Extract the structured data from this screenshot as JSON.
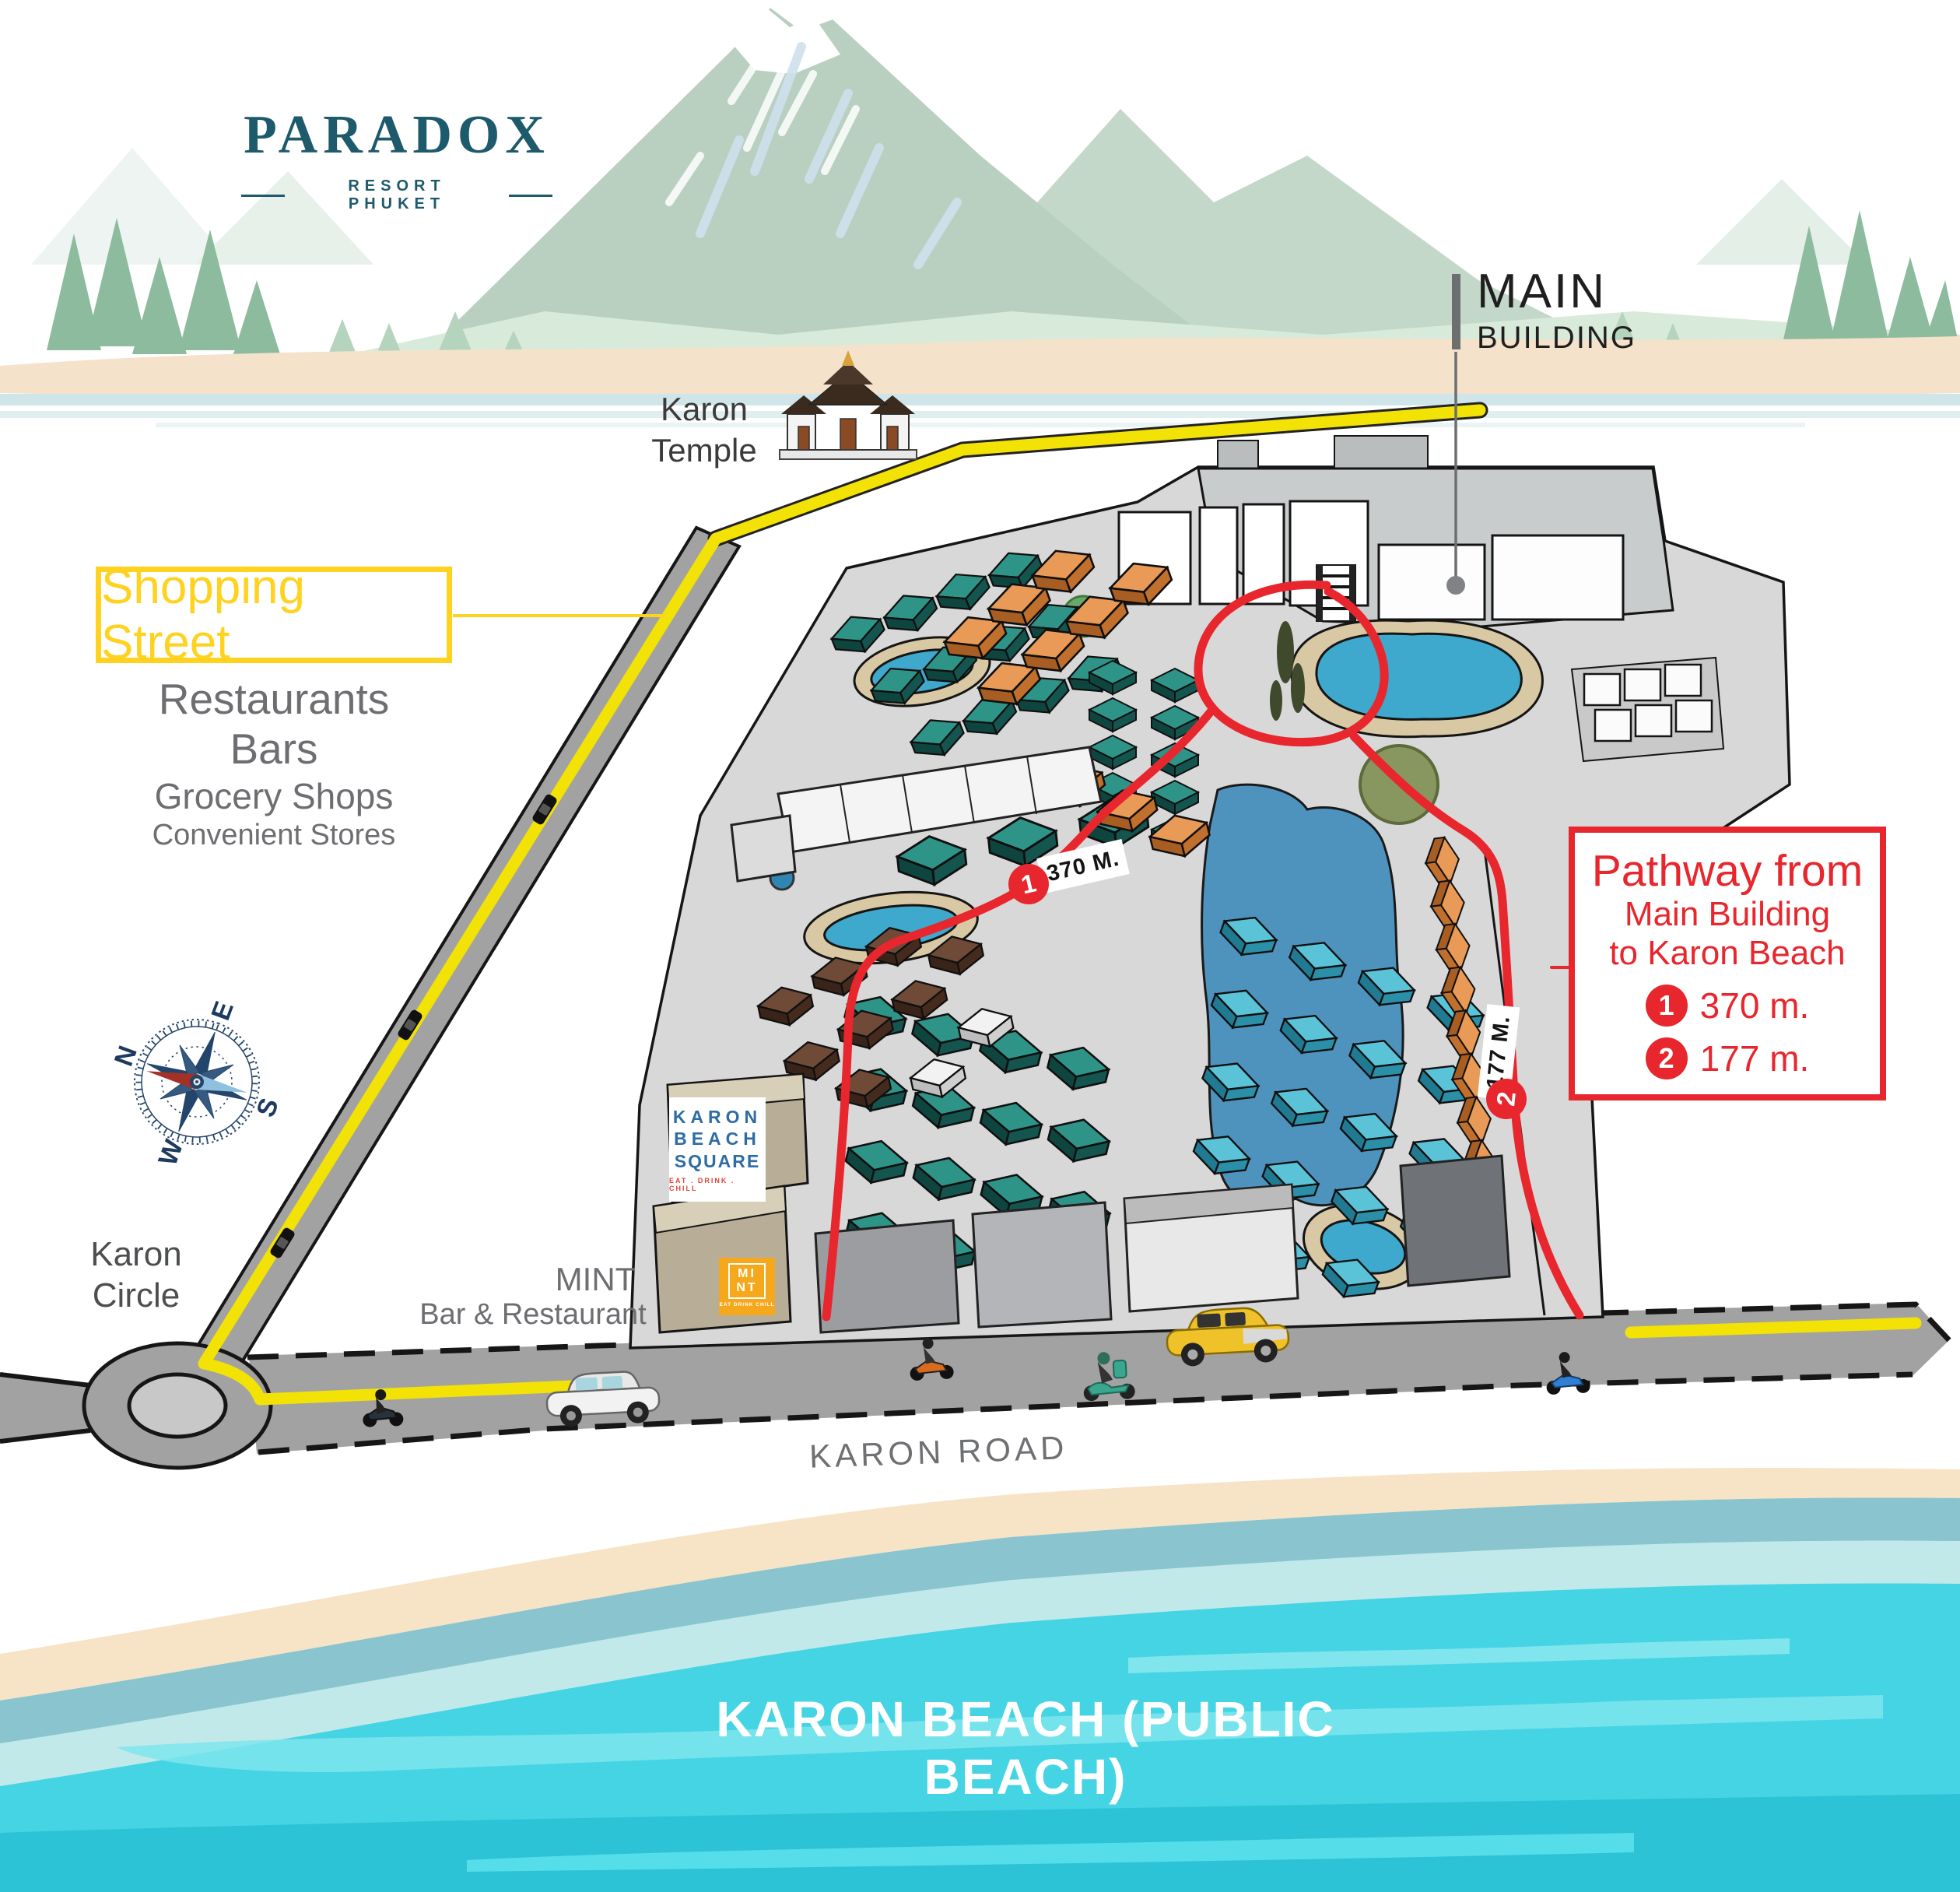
{
  "brand": {
    "name": "PARADOX",
    "tagline": "RESORT PHUKET"
  },
  "labels": {
    "main_building_1": "MAIN",
    "main_building_2": "BUILDING",
    "temple_1": "Karon",
    "temple_2": "Temple",
    "circle_1": "Karon",
    "circle_2": "Circle",
    "road": "KARON ROAD",
    "beach": "KARON BEACH (PUBLIC BEACH)",
    "mint_1": "MINT",
    "mint_2": "Bar & Restaurant"
  },
  "shopping_street": {
    "title": "Shopping Street",
    "items": [
      "Restaurants",
      "Bars",
      "Grocery Shops",
      "Convenient Stores"
    ]
  },
  "pathway_box": {
    "title": "Pathway from",
    "line2": "Main Building",
    "line3": "to Karon Beach",
    "legend": [
      {
        "num": "1",
        "distance": "370 m."
      },
      {
        "num": "2",
        "distance": "177 m."
      }
    ]
  },
  "path_markers": [
    {
      "num": "1",
      "label": "370 M."
    },
    {
      "num": "2",
      "label": "177 M."
    }
  ],
  "compass": {
    "n": "N",
    "e": "E",
    "s": "S",
    "w": "W"
  },
  "kbs_logo": {
    "line1": "KARON",
    "line2": "BEACH",
    "line3": "SQUARE",
    "tagline": "EAT . DRINK . CHILL"
  },
  "mint_logo": {
    "line1": "MI",
    "line2": "NT",
    "tagline": "EAT DRINK CHILL"
  },
  "colors": {
    "brand_navy": "#1d5a6c",
    "accent_yellow": "#ffd21f",
    "road_yellow": "#f2e205",
    "accent_red": "#e8262d",
    "sea_turquoise": "#45d4e3",
    "kbs_blue": "#2d6da3",
    "mint_orange": "#f6a81c",
    "resort_ground": "#d8d8d8",
    "road_gray": "#a2a2a2"
  }
}
